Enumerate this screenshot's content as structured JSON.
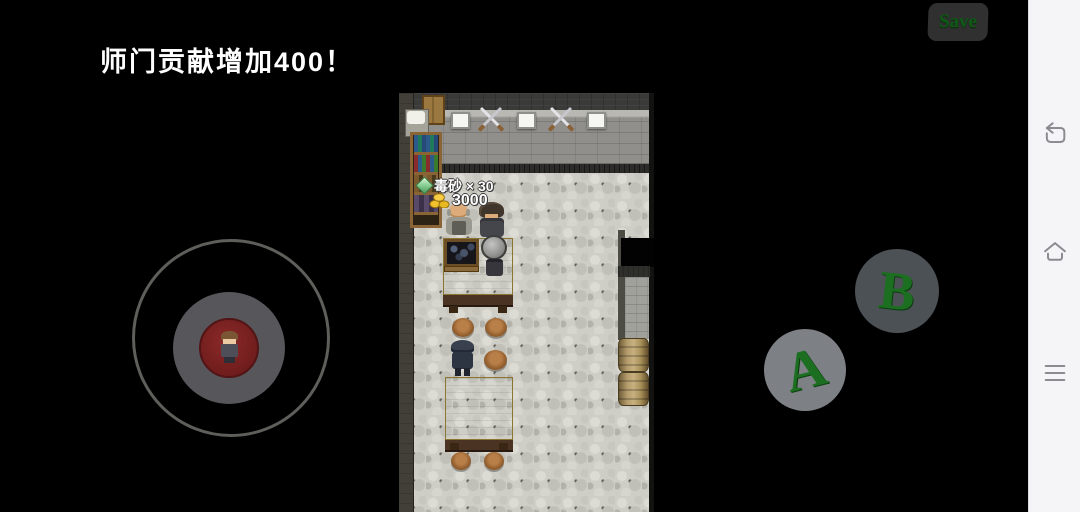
{
  "app": {
    "toast": "师门贡献增加400！",
    "save_button": "Save"
  },
  "game": {
    "hud": {
      "item_pickup": "毒砂 × 30",
      "gold_amount": "3000"
    }
  },
  "controls": {
    "button_a": "A",
    "button_b": "B"
  },
  "icons": {
    "navbar": [
      "back-icon",
      "home-icon",
      "menu-icon"
    ],
    "hud": [
      "gem-icon",
      "coins-icon"
    ],
    "wall_decor": [
      "plaque-icon",
      "crossed-swords-icon"
    ]
  },
  "colors": {
    "accent_green": "#1c6e20",
    "save_text_green": "#0e5a16",
    "toast_text": "#ffffff",
    "navbar_bg": "#f5f5f7",
    "joystick_red": "#6e1c1c",
    "button_a_bg": "#7d8185",
    "button_b_bg": "#4c5156",
    "table_tan": "#c9b35a",
    "floor_gray": "#cfcec6",
    "wall_gray": "#908f8b"
  }
}
